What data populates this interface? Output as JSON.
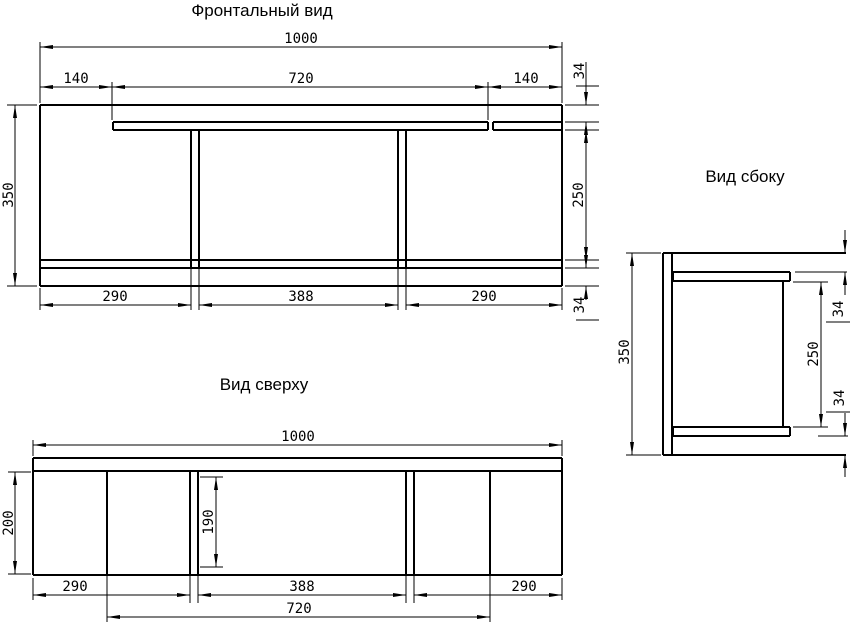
{
  "drawing": {
    "background": "#ffffff",
    "line_color": "#000000",
    "views": {
      "front": {
        "title": "Фронтальный вид",
        "dims": {
          "total_width": "1000",
          "left_offset": "140",
          "tabletop_length": "720",
          "right_offset": "140",
          "height": "350",
          "top_inset": "34",
          "clear_height": "250",
          "bottom_inset": "34",
          "left_bay": "290",
          "center_bay": "388",
          "right_bay": "290"
        }
      },
      "top": {
        "title": "Вид сверху",
        "dims": {
          "total_width": "1000",
          "depth": "200",
          "leg_depth": "190",
          "left_bay": "290",
          "center_bay": "388",
          "right_bay": "290",
          "tabletop_length": "720"
        }
      },
      "side": {
        "title": "Вид сбоку",
        "dims": {
          "height": "350",
          "top_inset": "34",
          "clear_height": "250",
          "bottom_inset": "34"
        }
      }
    }
  }
}
